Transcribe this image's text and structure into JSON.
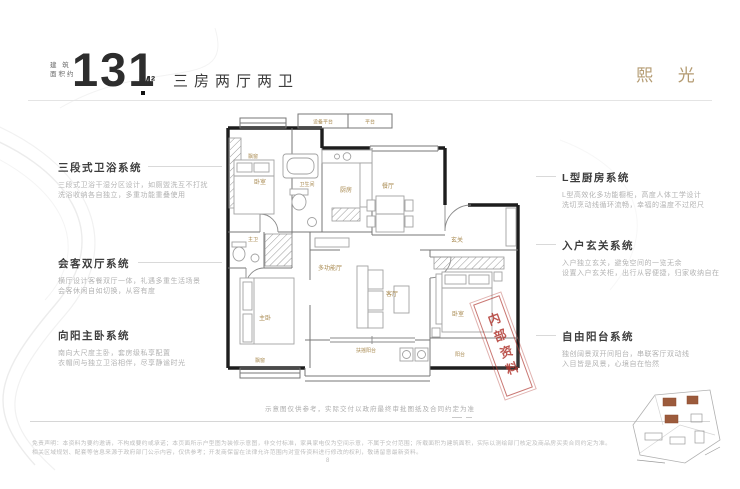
{
  "header": {
    "area_label1": "建 筑",
    "area_label2": "面积约",
    "area_value": "131",
    "area_unit": "M²",
    "layout": "三房两厅两卫",
    "product": "熙 光"
  },
  "annotations": {
    "left": [
      {
        "title": "三段式卫浴系统",
        "desc1": "三段式卫浴干湿分区设计，如厕盥洗互不打扰",
        "desc2": "洗浴收纳各自独立，多重功能重叠使用"
      },
      {
        "title": "会客双厅系统",
        "desc1": "横厅设计客餐双厅一体，礼遇多重生活场景",
        "desc2": "会客休闲自如切换，从容有度"
      },
      {
        "title": "向阳主卧系统",
        "desc1": "南向大尺度主卧，套房级私享配置",
        "desc2": "衣帽间与独立卫浴相伴，尽享静谧时光"
      }
    ],
    "right": [
      {
        "title": "L型厨房系统",
        "desc1": "L型高效化多功能橱柜，高度人体工学设计",
        "desc2": "洗切烹动线循环流畅，幸福的温度不过咫尺"
      },
      {
        "title": "入户玄关系统",
        "desc1": "入户独立玄关，避免空间的一览无余",
        "desc2": "设置入户玄关柜，出行从容便捷，归家收纳自在"
      },
      {
        "title": "自由阳台系统",
        "desc1": "独创阔景双开间阳台，串联客厅双动线",
        "desc2": "入目皆是风景，心境自在怡然"
      }
    ]
  },
  "floorplan": {
    "rooms": {
      "bedroom1": "卧室",
      "bay1": "飘窗",
      "bath": "卫生间",
      "kitchen": "厨房",
      "platform1": "设备平台",
      "platform2": "平台",
      "dining": "餐厅",
      "entry": "玄关",
      "living": "客厅",
      "multi": "多功能厅",
      "master": "主卧",
      "master_bath": "主卫",
      "master_bay": "飘窗",
      "bedroom2": "卧室",
      "balcony_side": "阳台",
      "balcony_main": "扶摇阳台"
    },
    "stamp": "内部资料"
  },
  "footer": {
    "caption": "示意图仅供参考，实际交付以政府最终审批图纸及合同约定为准",
    "disclaimer1": "免责声明：本资料为要约邀请，不构成要约或承诺；本页面所示户型图为装修示意图，非交付标准，家具家电仅为空间示意，不属于交付范围；所载面积为建筑面积，实际以测绘部门核定及商品房买卖合同约定为准。",
    "disclaimer2": "相关区域规划、配套等信息来源于政府部门公示内容，仅供参考；开发商保留在法律允许范围内对宣传资料进行修改的权利，敬请留意最新资料。",
    "page_mark": "8"
  },
  "colors": {
    "accent_gold": "#b49b72",
    "room_label_gold": "#a8894f",
    "stamp_red": "#b23a33",
    "wall_black": "#1d1d1d"
  }
}
